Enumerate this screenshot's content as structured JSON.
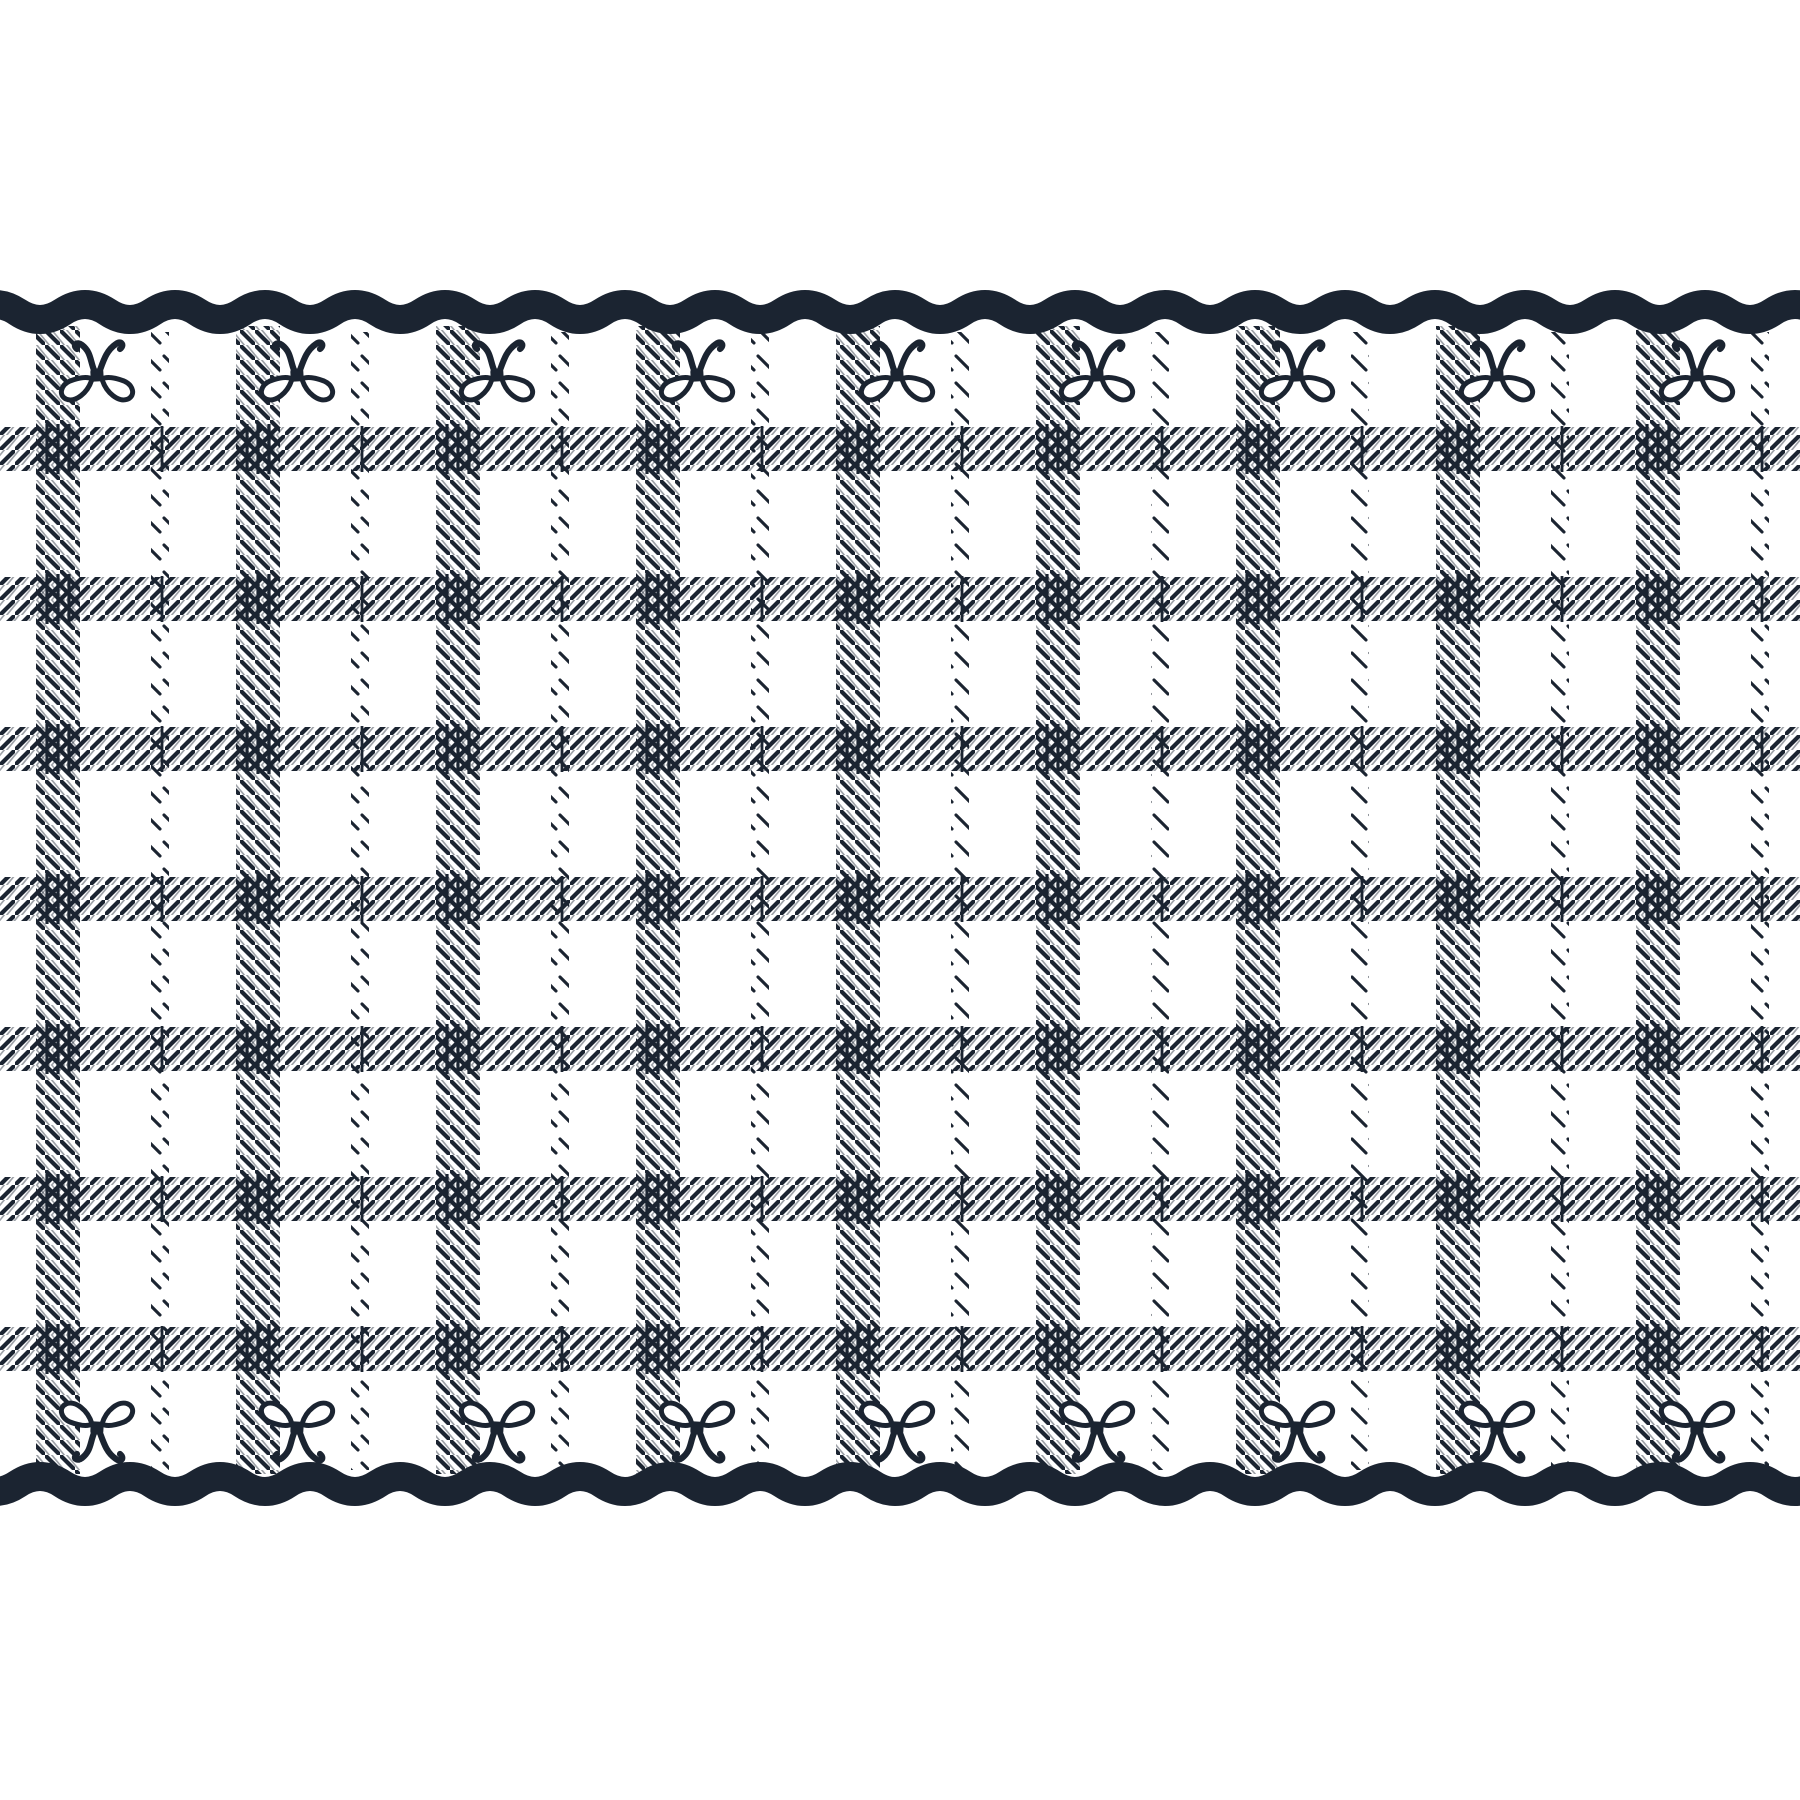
{
  "meta": {
    "description": "plaid ribbon wallpaper border with bows",
    "canvas": {
      "width": 1800,
      "height": 1800
    }
  },
  "palette": {
    "ink": "#1b2431",
    "paper": "#ffffff",
    "ghost_opacity": 0.42
  },
  "borders": {
    "top": {
      "name": "scallop-border-top",
      "center_y": 312,
      "thickness": 29,
      "wave_period": 90,
      "wave_amplitude": 7.5
    },
    "bottom": {
      "name": "scallop-border-bottom",
      "center_y": 1484,
      "thickness": 29,
      "wave_period": 90,
      "wave_amplitude": 7.5
    }
  },
  "plaid": {
    "wide_columns": {
      "count": 9,
      "first_x": 39,
      "spacing": 200,
      "width": 38,
      "top": 326,
      "bottom": 1474,
      "hatch": "backslash"
    },
    "narrow_columns": {
      "count": 9,
      "first_x": 152,
      "spacing": 200,
      "width": 16,
      "top": 332,
      "bottom": 1470,
      "hatch": "backslash-dashed"
    },
    "rows": {
      "count": 7,
      "first_y": 430,
      "spacing": 150,
      "height": 38,
      "left": 0,
      "right": 1800,
      "hatch": "slash"
    },
    "hatch": {
      "tile": 15,
      "main_stroke": 4.2,
      "ghost_stroke": 1.7,
      "dash_tile_w": 18,
      "dash_tile_h": 27,
      "dash_stroke": 3.1,
      "tick_offsets_wide": [
        8,
        19,
        30
      ],
      "tick_offset_narrow": 10,
      "tick_stroke": 3.2
    }
  },
  "bows": {
    "top_row": {
      "name": "bow-row-top",
      "count": 9,
      "first_x": 97,
      "spacing": 200,
      "y": 375,
      "flipped": true
    },
    "bottom_row": {
      "name": "bow-row-bottom",
      "count": 9,
      "first_x": 97,
      "spacing": 200,
      "y": 1428,
      "flipped": false
    }
  }
}
